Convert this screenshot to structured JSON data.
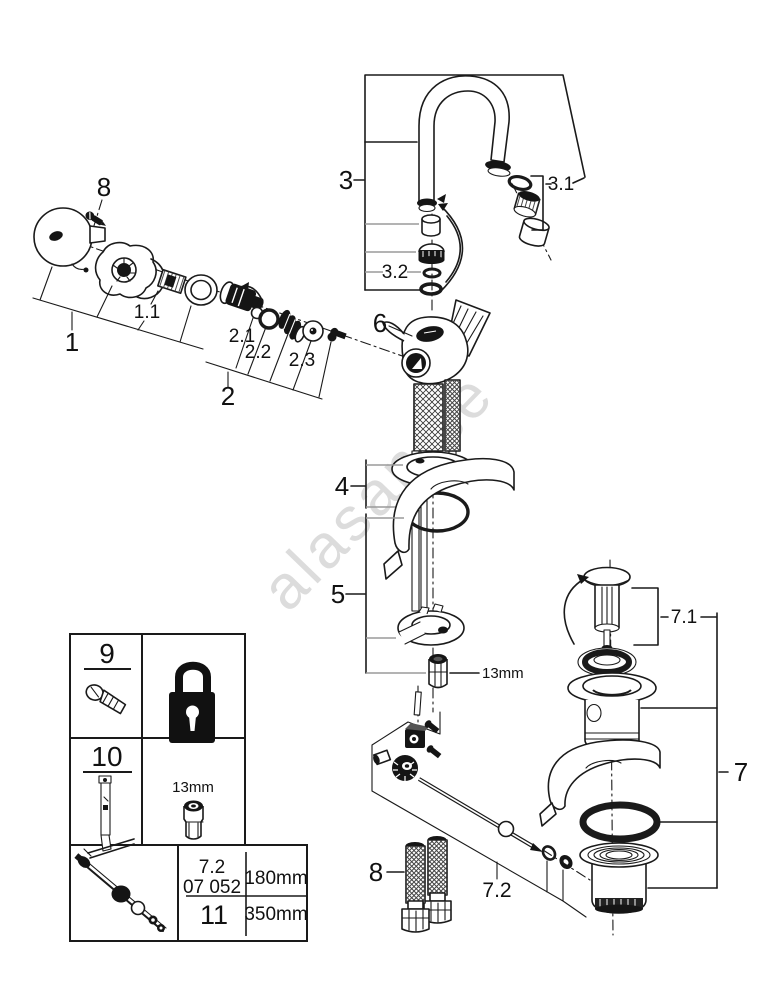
{
  "watermark": "alasan.se",
  "callouts": {
    "p1": "1",
    "p1_1": "1.1",
    "p2": "2",
    "p2_1": "2.1",
    "p2_2": "2.2",
    "p2_3": "2.3",
    "p3": "3",
    "p3_1": "3.1",
    "p3_2": "3.2",
    "p4": "4",
    "p5": "5",
    "p6": "6",
    "p7": "7",
    "p7_1": "7.1",
    "p7_2": "7.2",
    "p8": "8",
    "nut_size": "13mm"
  },
  "table": {
    "r9": "9",
    "r10": "10",
    "socket_size": "13mm",
    "ref_part": "7.2",
    "ref_code": "07 052",
    "r11": "11",
    "len_short": "180mm",
    "len_long": "350mm",
    "icons": {
      "cell9_left": "fixing-screw-icon",
      "cell9_right": "padlock-icon",
      "cell10_left": "lift-rod-tool-icon",
      "cell10_right": "socket-13mm-icon",
      "cell11_left": "pop-up-rod-icon"
    }
  },
  "colors": {
    "line": "#1a1a1a",
    "leader_gray": "#9a9a9a",
    "watermark": "#dcdcdc",
    "background": "#ffffff"
  }
}
